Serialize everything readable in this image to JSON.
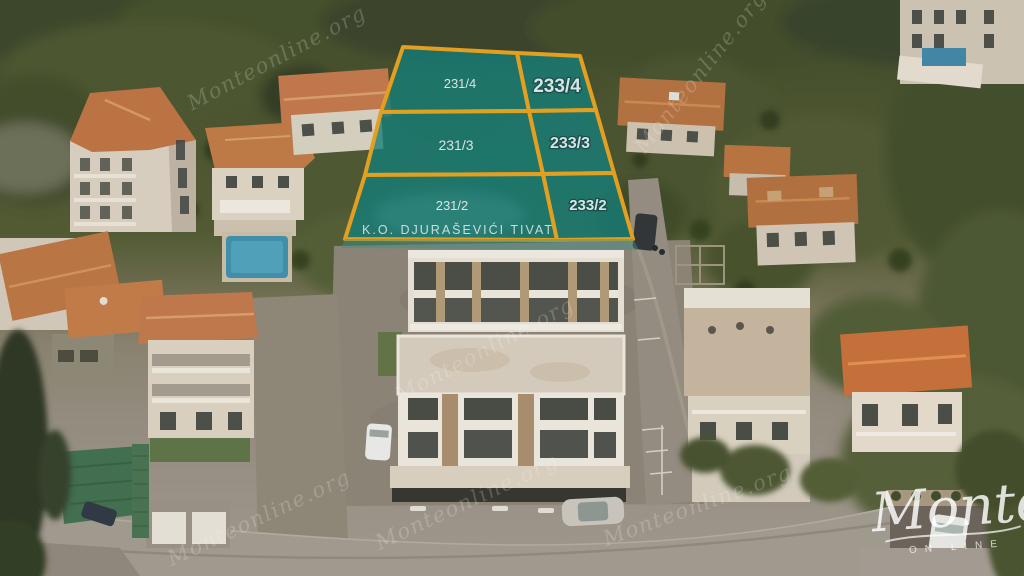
{
  "overlay": {
    "parcel_fill": "#0E7D7B",
    "parcel_border": "#E8A21D",
    "cadastral_label": "K.O. DJURAŠEVIĆI TIVAT",
    "parcels": [
      {
        "id": "231/4"
      },
      {
        "id": "233/4"
      },
      {
        "id": "231/3"
      },
      {
        "id": "233/3"
      },
      {
        "id": "231/2"
      },
      {
        "id": "233/2"
      }
    ]
  },
  "watermark": {
    "text": "Monteonline.org"
  },
  "logo": {
    "name": "Monte",
    "tagline": "ON LINE"
  }
}
